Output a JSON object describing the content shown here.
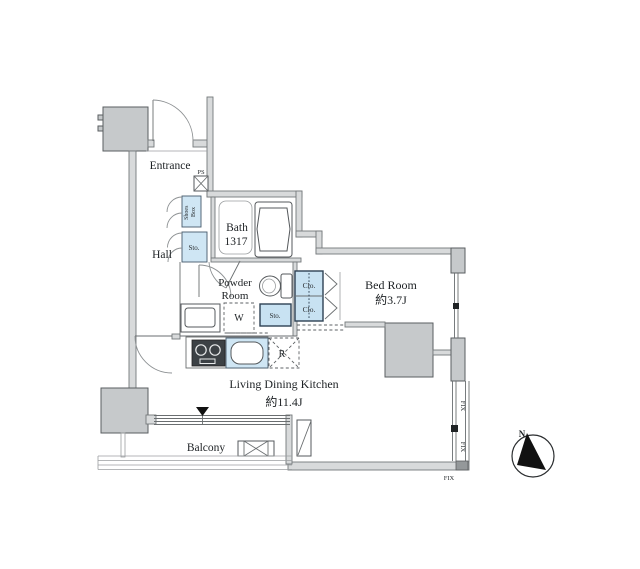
{
  "floor_plan": {
    "rooms": {
      "entrance": {
        "label": "Entrance"
      },
      "hall": {
        "label": "Hall"
      },
      "bath": {
        "label_line1": "Bath",
        "label_line2": "1317"
      },
      "powder_room": {
        "label_line1": "Powder",
        "label_line2": "Room"
      },
      "bedroom": {
        "label": "Bed Room",
        "size": "約3.7J"
      },
      "living_dining_kitchen": {
        "label": "Living Dining Kitchen",
        "size": "約11.4J"
      },
      "balcony": {
        "label": "Balcony"
      }
    },
    "fixtures": {
      "shoes_box": {
        "line1": "Shoes",
        "line2": "Box"
      },
      "hall_storage": {
        "label": "Sto."
      },
      "powder_storage": {
        "label": "Sto."
      },
      "washing_machine": {
        "label": "W"
      },
      "refrigerator": {
        "label": "R"
      },
      "closet_upper": {
        "label": "Clo."
      },
      "closet_lower": {
        "label": "Clo."
      },
      "pipe_space": {
        "label": "PS"
      }
    },
    "windows": {
      "fix_upper": "FIX",
      "fix_lower": "FIX",
      "fix_bottom": "FIX"
    },
    "compass": {
      "north_label": "N"
    },
    "colors": {
      "fixture_blue": "#cfe6f4",
      "wall_fill": "#d8dadb",
      "pillar_fill": "#c6c9cb",
      "line": "#55595c"
    }
  }
}
